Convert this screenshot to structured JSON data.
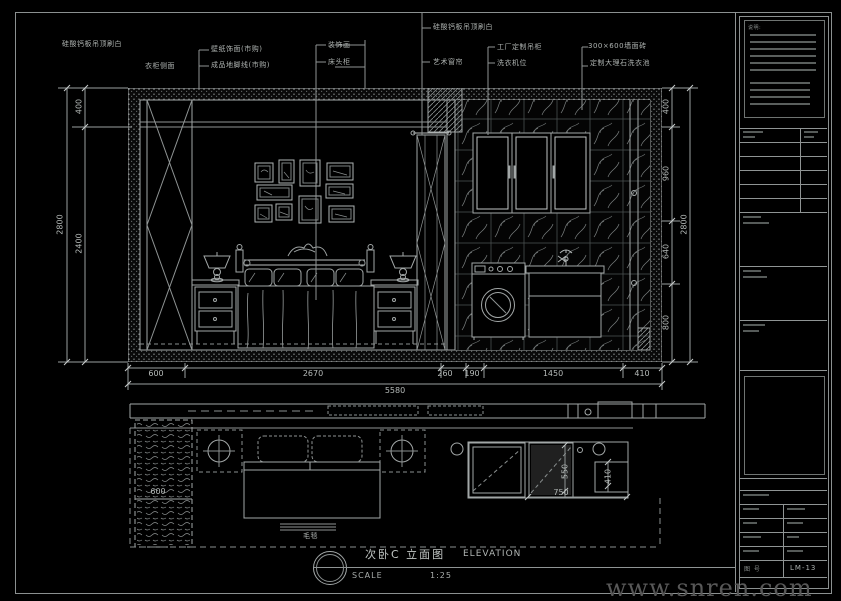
{
  "callouts": {
    "c1": "硅酸钙板吊顶刷白",
    "c2": "衣柜侧面",
    "c3": "壁纸饰面(市购)",
    "c4": "成品地脚线(市购)",
    "c5": "装饰画",
    "c6": "床头柜",
    "c7": "硅酸钙板吊顶刷白",
    "c8": "艺术窗帘",
    "c9": "工厂定制吊柜",
    "c10": "洗衣机位",
    "c11": "300×600墙面砖",
    "c12": "定制大理石洗衣池"
  },
  "dims": {
    "left_total": "2800",
    "left_top": "400",
    "left_bottom": "2400",
    "right_1": "400",
    "right_2": "960",
    "right_3": "640",
    "right_4": "800",
    "right_total": "2800",
    "bottom_1": "600",
    "bottom_2": "2670",
    "bottom_3": "260",
    "bottom_4": "190",
    "bottom_5": "1450",
    "bottom_6": "410",
    "bottom_total": "5580",
    "plan_wardrobe": "600",
    "plan_sink_depth": "550",
    "plan_sink_width": "750",
    "plan_cabinet": "410"
  },
  "plan": {
    "bed_label": "毛毯"
  },
  "titlebar": {
    "drawing_title": "次卧C 立面图",
    "elevation_label": "ELEVATION",
    "scale_label": "SCALE",
    "scale_value": "1:25"
  },
  "titleblock": {
    "notes_title": "说明:",
    "sheet_no_label": "图 号",
    "sheet_no": "LM-13"
  },
  "watermark": "www.snren.com",
  "colors": {
    "line": "#a2a7a7",
    "dim_text": "#b5bab8",
    "background": "#000000"
  }
}
